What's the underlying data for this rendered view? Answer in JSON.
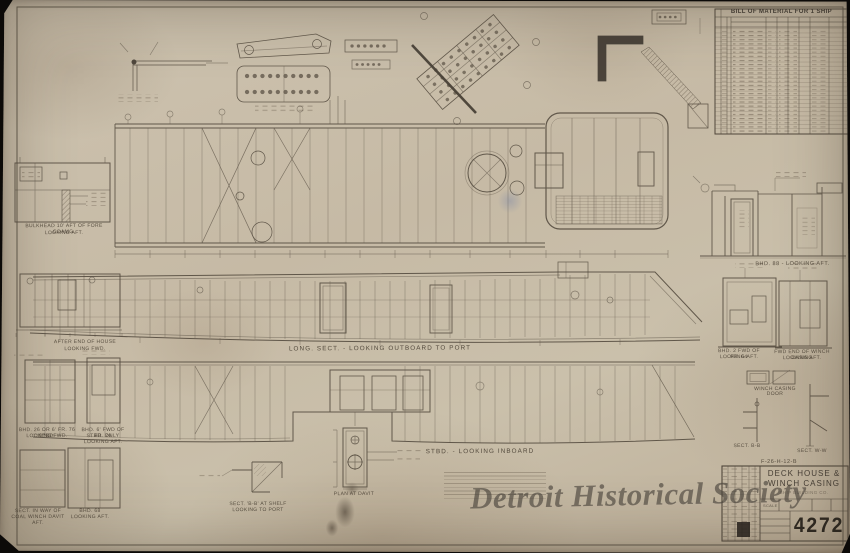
{
  "document": {
    "watermark": "Detroit Historical Society"
  },
  "bill_of_material": {
    "title": "BILL OF MATERIAL FOR 1 SHIP"
  },
  "title_block": {
    "title_line1": "DECK HOUSE &",
    "title_line2": "WINCH CASING",
    "company_line": "SHIP BUILDING CO.",
    "scale_label": "SCALE",
    "drawing_number": "4272",
    "ref_number": "F-26-H-12-B"
  },
  "view_labels": {
    "bulkhead_fore_1": "BULKHEAD 10' AFT OF FORE COAMG.",
    "bulkhead_fore_2": "LOOKING AFT.",
    "long_section": "LONG. SECT. - LOOKING OUTBOARD TO PORT",
    "stbd_section": "STBD. - LOOKING INBOARD",
    "bhd_88_looking_aft": "BHD. 88 - LOOKING AFT.",
    "after_end_1": "AFTER END OF HOUSE",
    "after_end_2": "LOOKING FWD.",
    "bhd_26_1": "BHD. 26 OR 6' FR. 76 STBD.",
    "bhd_26_2": "LOOKING FWD.",
    "bhd_6fwd_1": "BHD. 6' FWD OF FR. 76",
    "bhd_6fwd_2": "STBD. ONLY LOOKING AFT.",
    "sect_way_1": "SECT. IN WAY OF",
    "sect_way_2": "COAL WINCH DAVIT AFT.",
    "bhd_68_1": "BHD. 68",
    "bhd_68_2": "LOOKING AFT.",
    "bhd_2fwd_1": "BHD. 2 FWD OF FR. 64",
    "bhd_2fwd_2": "LOOKING AFT.",
    "fwd_end_1": "FWD END OF WINCH CASING",
    "fwd_end_2": "LOOKING AFT.",
    "winch_door_1": "WINCH CASING",
    "winch_door_2": "DOOR",
    "sect_bb": "SECT. B-B",
    "sect_ww": "SECT. W-W",
    "plan_davit": "PLAN AT DAVIT",
    "sect_shelf_1": "SECT. 'B-B' AT SHELF",
    "sect_shelf_2": "LOOKING TO PORT"
  }
}
